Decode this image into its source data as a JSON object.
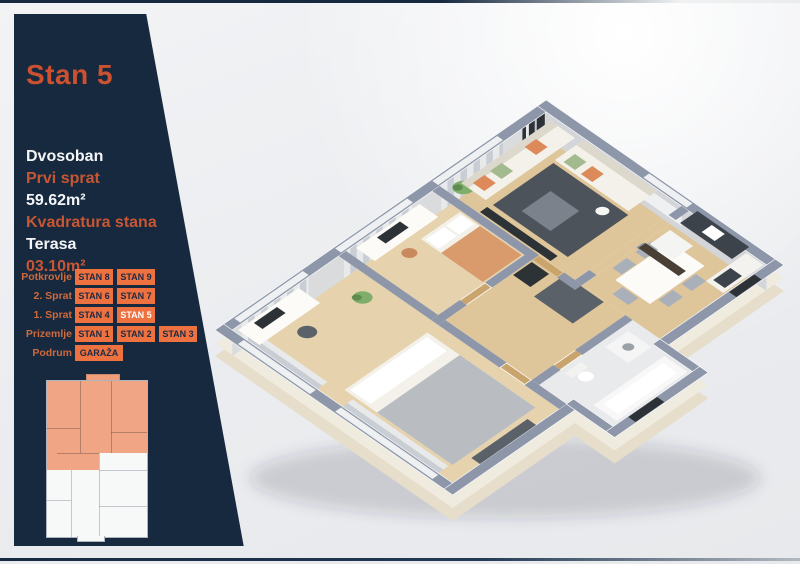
{
  "sidebar": {
    "title": "Stan 5",
    "details": [
      {
        "text": "Dvosoban",
        "style": "primary"
      },
      {
        "text": "Prvi sprat",
        "style": "accent"
      },
      {
        "text": "59.62m²",
        "style": "primary"
      },
      {
        "text": "Kvadratura stana",
        "style": "accent"
      },
      {
        "text": "Terasa",
        "style": "primary"
      },
      {
        "text": "03.10m²",
        "style": "accent"
      }
    ]
  },
  "floor_selector": {
    "rows": [
      {
        "label": "Potkrovlje",
        "units": [
          {
            "label": "STAN 8",
            "selected": false
          },
          {
            "label": "STAN 9",
            "selected": false
          }
        ]
      },
      {
        "label": "2. Sprat",
        "units": [
          {
            "label": "STAN 6",
            "selected": false
          },
          {
            "label": "STAN 7",
            "selected": false
          }
        ]
      },
      {
        "label": "1. Sprat",
        "units": [
          {
            "label": "STAN 4",
            "selected": false
          },
          {
            "label": "STAN 5",
            "selected": true
          }
        ]
      },
      {
        "label": "Prizemlje",
        "units": [
          {
            "label": "STAN 1",
            "selected": false
          },
          {
            "label": "STAN 2",
            "selected": false
          },
          {
            "label": "STAN 3",
            "selected": false
          }
        ]
      },
      {
        "label": "Podrum",
        "units": [
          {
            "label": "GARAŽA",
            "selected": false
          }
        ]
      }
    ]
  },
  "colors": {
    "sidebar_bg": "#17293e",
    "accent_orange": "#cc5130",
    "button_orange": "#ee7140",
    "button_text": "#1b2b46",
    "selected_text": "#ffffff",
    "background": "#eceef0",
    "thumb_highlight": "#f0a585"
  },
  "plan_colors": {
    "wallTop": "#8e97a9",
    "wallFace": "#d9dbdd",
    "wallFace2": "#d3d5d8",
    "window": "#eef0f1",
    "slab": "#fbfaf6",
    "plinth": "#f0ebdf",
    "plinthDark": "#e6ddca",
    "woodA": "#e6d3ae",
    "woodB": "#dfc69a",
    "tile": "#e9eaec",
    "rug": "#4d535b",
    "dark": "#2d3237",
    "closet": "#5a6168",
    "sofa": "#f3f1ea",
    "sofaEdge": "#dcd8cc",
    "pillowOrange": "#dd8a5a",
    "pillowGreen": "#a3ba8f",
    "bedOrange": "#d99a6c",
    "blanketGray": "#b9bdc2",
    "white": "#fcfbf8",
    "chairGray": "#aab0ba",
    "counterDark": "#3d434b",
    "cabinetWood": "#c9a46c",
    "fridge": "#f4f4f2",
    "plantGreen": "#7fae6a",
    "plantDark": "#5d8c4e",
    "curtain": "#c9ced4",
    "curtainLight": "#e7e9eb",
    "shadow": "rgba(30,40,60,0.16)"
  }
}
